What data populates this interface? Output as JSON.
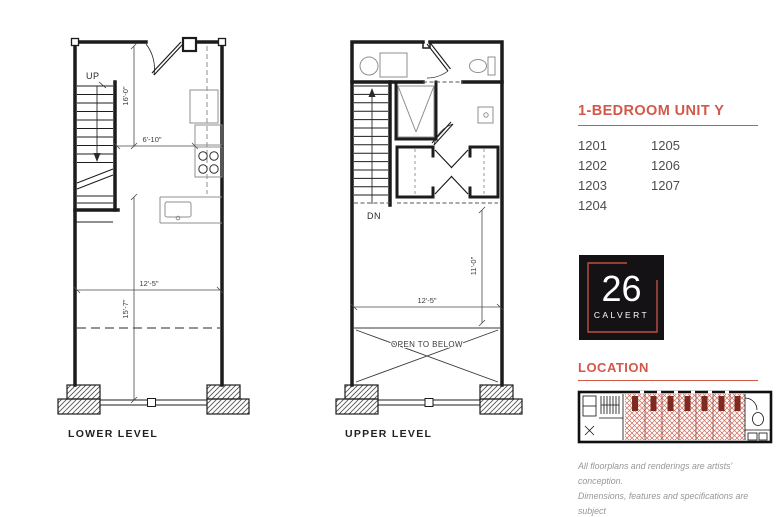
{
  "colors": {
    "accent": "#D2584A",
    "logo_bg": "#151215",
    "frame_red": "#BE4F3E",
    "ink": "#231F20",
    "unit_text": "#4D4D4F",
    "muted_gray": "#96979A",
    "hatch_red": "#CF6A5C"
  },
  "plans": {
    "lower": {
      "label": "LOWER LEVEL",
      "stair_label": "UP",
      "dims": {
        "stair_height": "16'-0\"",
        "kitchen_width": "6'-10\"",
        "room_width": "12'-5\"",
        "room_depth": "15'-7\""
      }
    },
    "upper": {
      "label": "UPPER LEVEL",
      "stair_label": "DN",
      "open_label": "OPEN TO BELOW",
      "dims": {
        "room_depth": "11'-0\"",
        "room_width": "12'-5\""
      }
    }
  },
  "sidebar": {
    "title": "1-BEDROOM UNIT Y",
    "units_col1": [
      "1201",
      "1202",
      "1203",
      "1204"
    ],
    "units_col2": [
      "1205",
      "1206",
      "1207"
    ],
    "logo": {
      "number": "26",
      "name": "CALVERT"
    },
    "location_title": "LOCATION",
    "disclaimer": [
      "All floorplans and renderings are artists' conception.",
      "Dimensions, features and specifications are subject",
      "to change at the discretion of the builder."
    ]
  }
}
